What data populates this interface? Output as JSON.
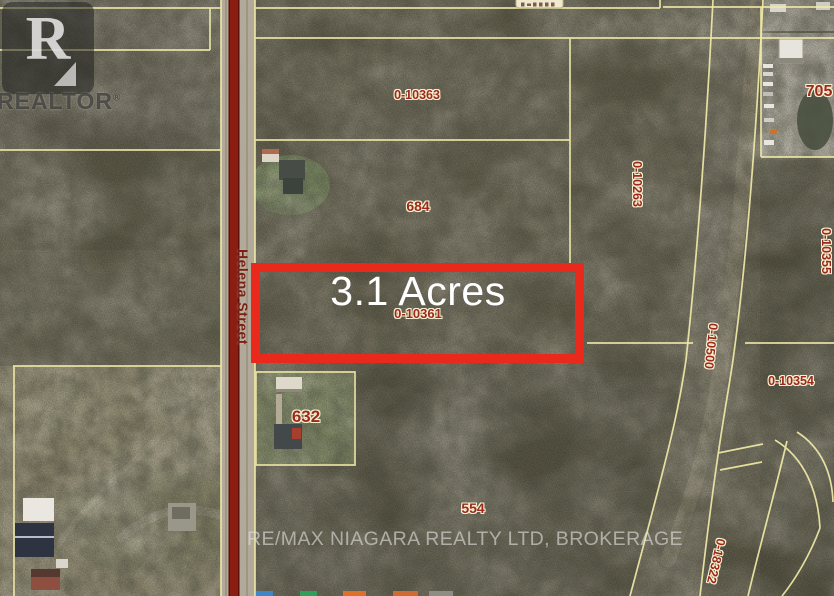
{
  "canvas": {
    "width": 834,
    "height": 596
  },
  "watermarks": {
    "logo_letter": "R",
    "logo_wordmark": "REALTOR",
    "registered_symbol": "®",
    "brokerage": "RE/MAX NIAGARA REALTY LTD, BROKERAGE"
  },
  "highlight": {
    "acreage": "3.1 Acres",
    "parcel_id": "0-10361",
    "border_color": "#e8291c"
  },
  "road": {
    "name": "Helena Street"
  },
  "parcels": {
    "p0_10363": "0-10363",
    "p684": "684",
    "p705": "705",
    "p0_10263": "0-10263",
    "p0_10355": "0-10355",
    "p0_10500": "0-10500",
    "p0_10354": "0-10354",
    "p632": "632",
    "p554": "554",
    "p0_18322": "0-18322"
  },
  "colors": {
    "parcel_line": "#f0e9a8",
    "parcel_label": "#9c2a1b",
    "road_line": "#8b1d12",
    "highlight_red": "#e8291c"
  },
  "footer_logo_fragments": {
    "colors": [
      "#3f86c9",
      "#2fa05a",
      "#e06f2a",
      "#cf6a33",
      "#8d8d85"
    ]
  }
}
